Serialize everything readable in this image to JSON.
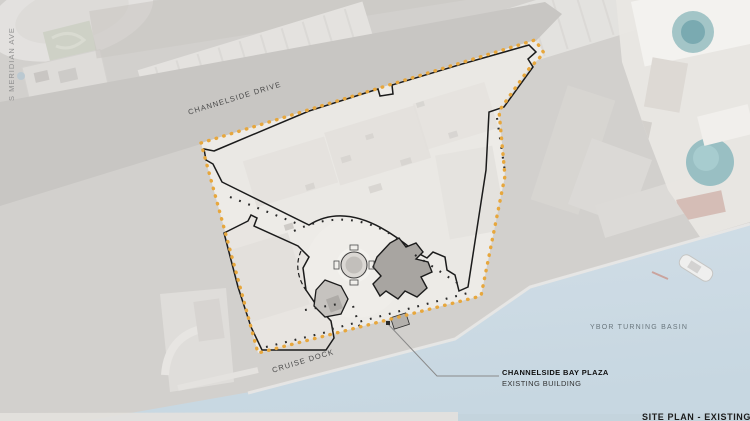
{
  "map": {
    "labels": {
      "meridian_ave": "S MERIDIAN AVE",
      "channelside_drive": "CHANNELSIDE DRIVE",
      "cruise_dock": "CRUISE DOCK",
      "ybor_basin": "YBOR TURNING BASIN"
    },
    "callout": {
      "title": "CHANNELSIDE BAY PLAZA",
      "subtitle": "EXISTING BUILDING"
    },
    "caption": "SITE PLAN - EXISTING",
    "colors": {
      "boundary_dots": "#E7A73D",
      "building_outline": "#1B1B1B",
      "water": "#CBDAE4",
      "ground_gray": "#D2D0CD",
      "site_fill": "#EDEBE7",
      "road_gray": "#C8C6C3"
    }
  }
}
